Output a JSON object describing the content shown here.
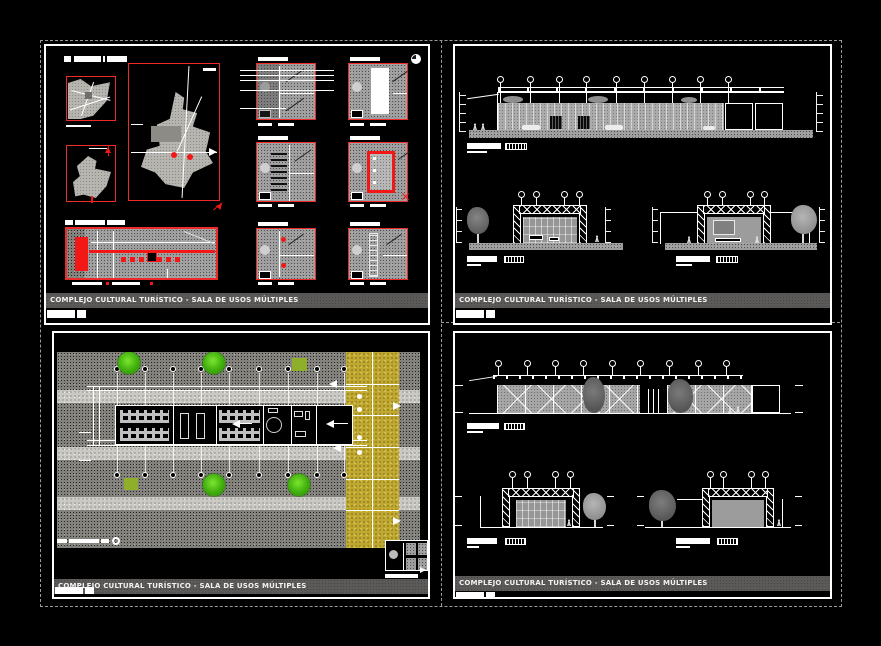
{
  "sheet": {
    "background": "#000000",
    "frame": {
      "panel_border": "#ffffff",
      "divider_color": "#9a9a9a"
    },
    "colors": {
      "accent_red": "#ee2b2b",
      "hatch_gray": "#9d9d9d",
      "ground_dark": "#83817b",
      "road_light": "#cbc9c3",
      "parking_yellow": "#c1a92f",
      "tree_green": "#3fae0d",
      "titlebar_gray": "#5b5a58"
    },
    "panels": [
      {
        "id": "location-and-details",
        "titlebar": "COMPLEJO CULTURAL TURÍSTICO - SALA DE USOS MÚLTIPLES"
      },
      {
        "id": "elevation-and-sections-a",
        "titlebar": "COMPLEJO CULTURAL TURÍSTICO - SALA DE USOS MÚLTIPLES"
      },
      {
        "id": "site-plan",
        "titlebar": "COMPLEJO CULTURAL TURÍSTICO - SALA DE USOS MÚLTIPLES"
      },
      {
        "id": "elevation-and-sections-b",
        "titlebar": "COMPLEJO CULTURAL TURÍSTICO - SALA DE USOS MÚLTIPLES"
      }
    ]
  }
}
